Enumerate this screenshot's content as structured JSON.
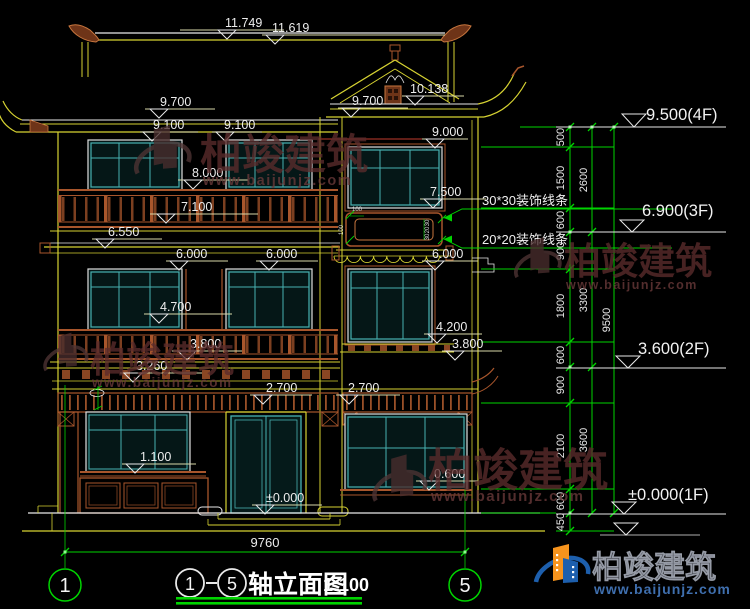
{
  "drawing": {
    "elevation_marks": [
      {
        "label": "11.749"
      },
      {
        "label": "11.619"
      },
      {
        "label": "10.138"
      },
      {
        "label": "9.700"
      },
      {
        "label": "9.700"
      },
      {
        "label": "9.100"
      },
      {
        "label": "9.100"
      },
      {
        "label": "9.000"
      },
      {
        "label": "8.000"
      },
      {
        "label": "7.500"
      },
      {
        "label": "7.100"
      },
      {
        "label": "6.550"
      },
      {
        "label": "6.000"
      },
      {
        "label": "6.000"
      },
      {
        "label": "6.000"
      },
      {
        "label": "4.700"
      },
      {
        "label": "4.200"
      },
      {
        "label": "3.800"
      },
      {
        "label": "3.800"
      },
      {
        "label": "3.260"
      },
      {
        "label": "2.700"
      },
      {
        "label": "2.700"
      },
      {
        "label": "1.100"
      },
      {
        "label": "0.600"
      },
      {
        "label": "±0.000"
      }
    ],
    "floor_levels": [
      "9.500(4F)",
      "6.900(3F)",
      "3.600(2F)",
      "±0.000(1F)"
    ],
    "dim_chain_inner": [
      "500",
      "1500",
      "600",
      "900",
      "1800",
      "600",
      "900",
      "2100",
      "600",
      "450"
    ],
    "dim_chain_mid": [
      "2600",
      "3300",
      "3600"
    ],
    "dim_chain_outer": [
      "9500"
    ],
    "bottom_width": "9760",
    "leader_notes": [
      "30*30装饰线条",
      "20*20装饰线条"
    ],
    "panel_micro_dims": [
      "100",
      "100",
      "30",
      "20",
      "30"
    ],
    "axis_bubbles": [
      "1",
      "5"
    ]
  },
  "title_bar": {
    "axis_start": "1",
    "axis_end": "5",
    "title": "轴立面图",
    "scale": "1:100"
  },
  "watermark": {
    "brand": "柏竣建筑",
    "url": "www.baijunjz.com"
  },
  "logo": {
    "brand": "柏竣建筑",
    "url": "www.baijunjz.com"
  },
  "colors": {
    "background": "#000000",
    "line_yellow": "#d6d232",
    "line_white": "#e9e9e9",
    "dimension_green": "#00d400",
    "window_teal": "#48b2b2",
    "wood_brown": "#a8562c",
    "accent_red": "#c23b2e",
    "watermark_maroon": "#5c2c2c",
    "logo_blue": "#1d5fad",
    "logo_orange": "#f7941d"
  }
}
